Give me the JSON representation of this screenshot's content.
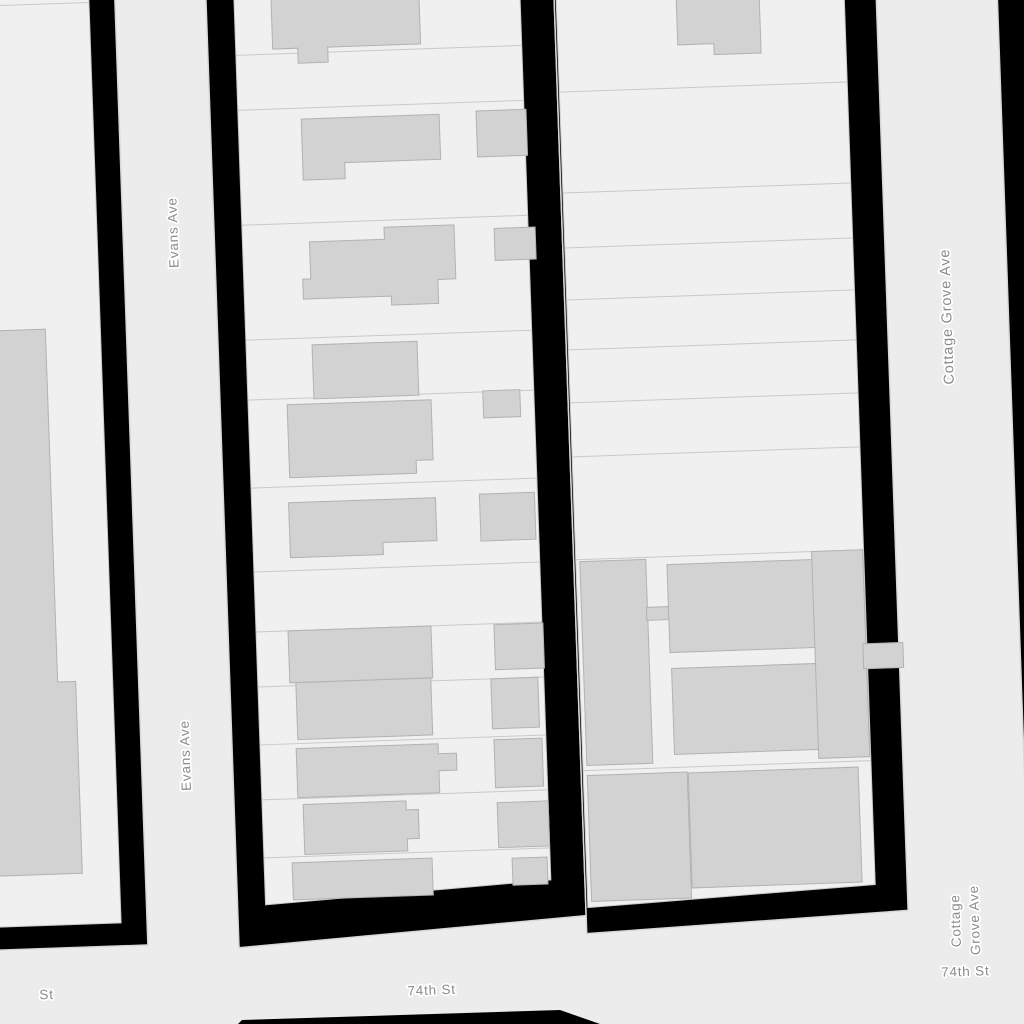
{
  "map": {
    "type": "parcel-basemap",
    "streets": [
      "Evans Ave",
      "Cottage Grove Ave",
      "74th St"
    ],
    "labels": {
      "evans_ave": "Evans Ave",
      "cottage_grove_ave": "Cottage Grove Ave",
      "cottage_grove_line1": "Cottage",
      "cottage_grove_line2": "Grove Ave",
      "seventy_fourth_st": "74th St",
      "partial_street_suffix": "St"
    },
    "colors": {
      "street": "#ececec",
      "street_edge": "#d8d8d8",
      "parcel": "#f0f0f0",
      "parcel_line": "#c9c9c9",
      "building_fill": "#d2d2d2",
      "building_outline": "#b2b2b2",
      "block_casing": "#000000",
      "label_text": "#8b8b8b",
      "label_halo": "#ffffff"
    }
  }
}
